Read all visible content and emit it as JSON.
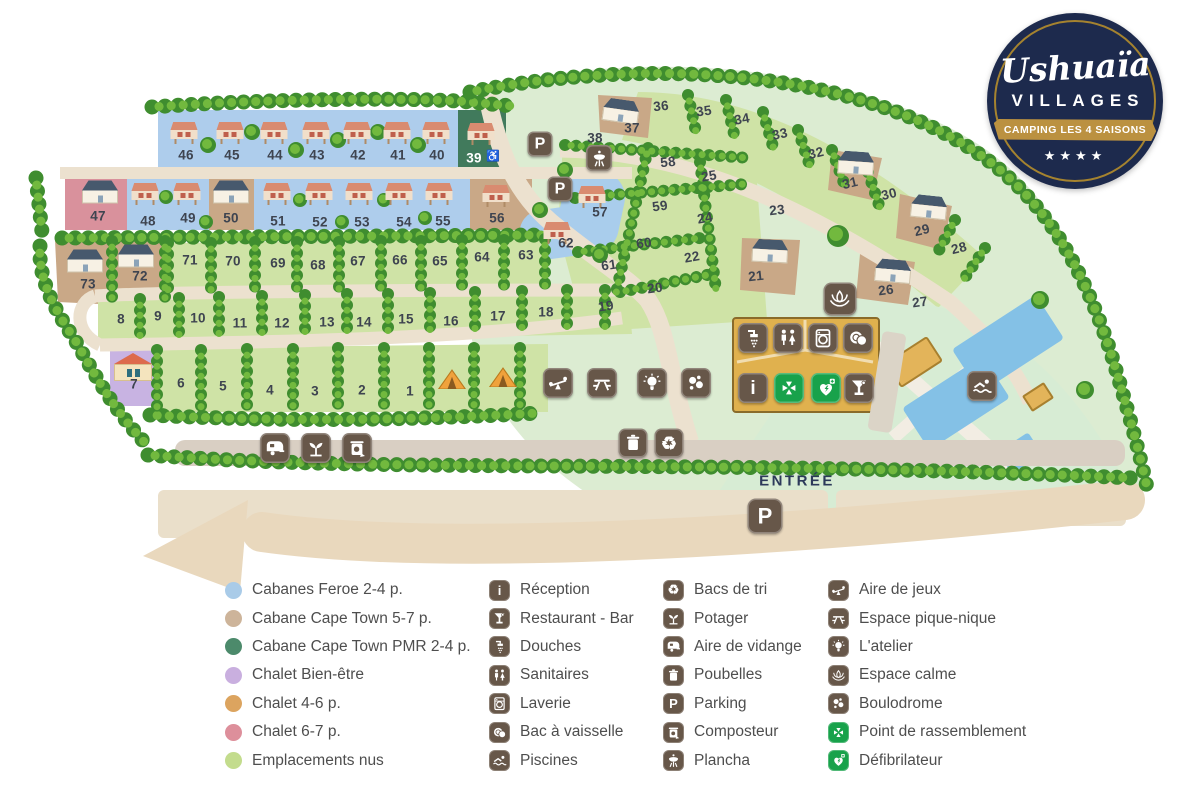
{
  "logo": {
    "brand": "Ushuaïa",
    "sub": "VILLAGES",
    "ribbon": "CAMPING LES 4 SAISONS",
    "stars": "★★★★"
  },
  "map": {
    "entrance_label": "ENTRÉE",
    "palette": {
      "pitch_green": "#cfe3a6",
      "zone_green": "#dcecd2",
      "road": "#ece1cf",
      "entry_road": "#d9cfc3",
      "swoosh": "#e9d8bd",
      "blue_cabins": "#aecdec",
      "tan": "#c9a887",
      "pink": "#d9919c",
      "pmr_green": "#417a5c",
      "purple": "#c8b3e2",
      "facility_block": "#e0b14e",
      "icon_brown": "#675749",
      "icon_green": "#18a24b",
      "pool_blue": "#84c1e6",
      "navy": "#1d2a4d"
    },
    "pitches": [
      {
        "n": "46",
        "x": 186,
        "y": 155
      },
      {
        "n": "45",
        "x": 232,
        "y": 155
      },
      {
        "n": "44",
        "x": 275,
        "y": 155
      },
      {
        "n": "43",
        "x": 317,
        "y": 155
      },
      {
        "n": "42",
        "x": 358,
        "y": 155
      },
      {
        "n": "41",
        "x": 398,
        "y": 155
      },
      {
        "n": "40",
        "x": 437,
        "y": 155
      },
      {
        "n": "39",
        "x": 474,
        "y": 158,
        "light": true
      },
      {
        "n": "38",
        "x": 595,
        "y": 138
      },
      {
        "n": "37",
        "x": 632,
        "y": 128
      },
      {
        "n": "47",
        "x": 98,
        "y": 216
      },
      {
        "n": "48",
        "x": 148,
        "y": 221
      },
      {
        "n": "49",
        "x": 188,
        "y": 218
      },
      {
        "n": "50",
        "x": 231,
        "y": 218
      },
      {
        "n": "51",
        "x": 278,
        "y": 221
      },
      {
        "n": "52",
        "x": 320,
        "y": 222
      },
      {
        "n": "53",
        "x": 362,
        "y": 222
      },
      {
        "n": "54",
        "x": 404,
        "y": 222
      },
      {
        "n": "55",
        "x": 443,
        "y": 221
      },
      {
        "n": "56",
        "x": 497,
        "y": 218
      },
      {
        "n": "57",
        "x": 600,
        "y": 212
      },
      {
        "n": "62",
        "x": 566,
        "y": 243
      },
      {
        "n": "36",
        "x": 661,
        "y": 106,
        "r": -6
      },
      {
        "n": "35",
        "x": 704,
        "y": 111,
        "r": -8
      },
      {
        "n": "34",
        "x": 742,
        "y": 119,
        "r": -10
      },
      {
        "n": "33",
        "x": 780,
        "y": 134,
        "r": -12
      },
      {
        "n": "32",
        "x": 816,
        "y": 153,
        "r": -14
      },
      {
        "n": "31",
        "x": 850,
        "y": 183,
        "r": -14
      },
      {
        "n": "30",
        "x": 889,
        "y": 194,
        "r": -14
      },
      {
        "n": "29",
        "x": 922,
        "y": 230,
        "r": -14
      },
      {
        "n": "28",
        "x": 959,
        "y": 248,
        "r": -14
      },
      {
        "n": "27",
        "x": 920,
        "y": 302,
        "r": -8
      },
      {
        "n": "26",
        "x": 886,
        "y": 290,
        "r": -8
      },
      {
        "n": "25",
        "x": 709,
        "y": 176,
        "r": -10
      },
      {
        "n": "24",
        "x": 705,
        "y": 218,
        "r": -10
      },
      {
        "n": "23",
        "x": 777,
        "y": 210,
        "r": -6
      },
      {
        "n": "22",
        "x": 692,
        "y": 257,
        "r": -10
      },
      {
        "n": "21",
        "x": 756,
        "y": 276,
        "r": -6
      },
      {
        "n": "20",
        "x": 655,
        "y": 288,
        "r": -8
      },
      {
        "n": "19",
        "x": 606,
        "y": 306,
        "r": -8
      },
      {
        "n": "58",
        "x": 668,
        "y": 162,
        "r": -6
      },
      {
        "n": "59",
        "x": 660,
        "y": 206,
        "r": -8
      },
      {
        "n": "60",
        "x": 644,
        "y": 243,
        "r": -8
      },
      {
        "n": "61",
        "x": 609,
        "y": 265,
        "r": -8
      },
      {
        "n": "73",
        "x": 88,
        "y": 284
      },
      {
        "n": "72",
        "x": 140,
        "y": 276
      },
      {
        "n": "71",
        "x": 190,
        "y": 260
      },
      {
        "n": "70",
        "x": 233,
        "y": 261
      },
      {
        "n": "69",
        "x": 278,
        "y": 263
      },
      {
        "n": "68",
        "x": 318,
        "y": 265
      },
      {
        "n": "67",
        "x": 358,
        "y": 261
      },
      {
        "n": "66",
        "x": 400,
        "y": 260
      },
      {
        "n": "65",
        "x": 440,
        "y": 261
      },
      {
        "n": "64",
        "x": 482,
        "y": 257
      },
      {
        "n": "63",
        "x": 526,
        "y": 255
      },
      {
        "n": "8",
        "x": 121,
        "y": 319
      },
      {
        "n": "9",
        "x": 158,
        "y": 316
      },
      {
        "n": "10",
        "x": 198,
        "y": 318
      },
      {
        "n": "11",
        "x": 240,
        "y": 323
      },
      {
        "n": "12",
        "x": 282,
        "y": 323
      },
      {
        "n": "13",
        "x": 327,
        "y": 322
      },
      {
        "n": "14",
        "x": 364,
        "y": 322
      },
      {
        "n": "15",
        "x": 406,
        "y": 319
      },
      {
        "n": "16",
        "x": 451,
        "y": 321
      },
      {
        "n": "17",
        "x": 498,
        "y": 316
      },
      {
        "n": "18",
        "x": 546,
        "y": 312
      },
      {
        "n": "7",
        "x": 134,
        "y": 384
      },
      {
        "n": "6",
        "x": 181,
        "y": 383
      },
      {
        "n": "5",
        "x": 223,
        "y": 386
      },
      {
        "n": "4",
        "x": 270,
        "y": 390
      },
      {
        "n": "3",
        "x": 315,
        "y": 391
      },
      {
        "n": "2",
        "x": 362,
        "y": 390
      },
      {
        "n": "1",
        "x": 410,
        "y": 391
      }
    ],
    "buildings": [
      {
        "t": "cabin",
        "x": 184,
        "y": 133
      },
      {
        "t": "cabin",
        "x": 230,
        "y": 133
      },
      {
        "t": "cabin",
        "x": 274,
        "y": 133
      },
      {
        "t": "cabin",
        "x": 316,
        "y": 133
      },
      {
        "t": "cabin",
        "x": 357,
        "y": 133
      },
      {
        "t": "cabin",
        "x": 397,
        "y": 133
      },
      {
        "t": "cabin",
        "x": 436,
        "y": 133
      },
      {
        "t": "cabin",
        "x": 481,
        "y": 134
      },
      {
        "t": "cabin",
        "x": 145,
        "y": 194
      },
      {
        "t": "cabin",
        "x": 187,
        "y": 194
      },
      {
        "t": "cabin",
        "x": 277,
        "y": 194
      },
      {
        "t": "cabin",
        "x": 319,
        "y": 194
      },
      {
        "t": "cabin",
        "x": 359,
        "y": 194
      },
      {
        "t": "cabin",
        "x": 399,
        "y": 194
      },
      {
        "t": "cabin",
        "x": 439,
        "y": 194
      },
      {
        "t": "cabin",
        "x": 592,
        "y": 197
      },
      {
        "t": "cabin",
        "x": 557,
        "y": 233
      },
      {
        "t": "cabin",
        "x": 496,
        "y": 196
      },
      {
        "t": "house",
        "x": 100,
        "y": 192
      },
      {
        "t": "house",
        "x": 231,
        "y": 192
      },
      {
        "t": "house",
        "x": 85,
        "y": 261
      },
      {
        "t": "house",
        "x": 136,
        "y": 256
      },
      {
        "t": "house",
        "x": 621,
        "y": 111,
        "r": 8
      },
      {
        "t": "house",
        "x": 856,
        "y": 163,
        "r": 4
      },
      {
        "t": "house",
        "x": 929,
        "y": 207,
        "r": 6
      },
      {
        "t": "house",
        "x": 770,
        "y": 251,
        "r": 3
      },
      {
        "t": "house",
        "x": 893,
        "y": 271,
        "r": 5
      },
      {
        "t": "chalet",
        "x": 133,
        "y": 367
      },
      {
        "t": "tent",
        "x": 452,
        "y": 379
      },
      {
        "t": "tent",
        "x": 503,
        "y": 377
      },
      {
        "t": "shed",
        "x": 914,
        "y": 362,
        "r": -33
      },
      {
        "t": "shed-sm",
        "x": 1038,
        "y": 397,
        "r": -33
      },
      {
        "t": "hall",
        "x": 887,
        "y": 382,
        "r": 9
      }
    ],
    "icons": [
      {
        "name": "parking-upper",
        "text": "P",
        "x": 540,
        "y": 144,
        "s": 25
      },
      {
        "name": "parking-mid",
        "text": "P",
        "x": 560,
        "y": 189,
        "s": 25
      },
      {
        "name": "plancha-map",
        "sym": "grill",
        "x": 599,
        "y": 158,
        "s": 26
      },
      {
        "name": "espace-calme-map",
        "sym": "lotus",
        "x": 840,
        "y": 299,
        "s": 33
      },
      {
        "name": "douches-map",
        "sym": "shower",
        "x": 753,
        "y": 338,
        "s": 30
      },
      {
        "name": "sanitaires-map",
        "sym": "wc",
        "x": 788,
        "y": 338,
        "s": 30
      },
      {
        "name": "laverie-map",
        "sym": "washer",
        "x": 823,
        "y": 338,
        "s": 30
      },
      {
        "name": "bac-vaisselle-map",
        "sym": "dishes",
        "x": 858,
        "y": 338,
        "s": 30
      },
      {
        "name": "reception-map",
        "text": "i",
        "x": 753,
        "y": 388,
        "s": 30
      },
      {
        "name": "rassemblement-map",
        "sym": "assembly",
        "x": 789,
        "y": 388,
        "s": 30,
        "green": true
      },
      {
        "name": "defibrilateur-map",
        "sym": "defib",
        "x": 826,
        "y": 388,
        "s": 30,
        "green": true
      },
      {
        "name": "restaurant-map",
        "sym": "bar",
        "x": 859,
        "y": 388,
        "s": 30
      },
      {
        "name": "aire-jeux-map",
        "sym": "seesaw",
        "x": 558,
        "y": 383,
        "s": 30
      },
      {
        "name": "pique-nique-map",
        "sym": "picnic",
        "x": 602,
        "y": 383,
        "s": 30
      },
      {
        "name": "atelier-map",
        "sym": "bulb",
        "x": 652,
        "y": 383,
        "s": 30
      },
      {
        "name": "boulodrome-map",
        "sym": "boules",
        "x": 696,
        "y": 383,
        "s": 30
      },
      {
        "name": "poubelles-map",
        "sym": "trash",
        "x": 633,
        "y": 443,
        "s": 29
      },
      {
        "name": "bacs-tri-map",
        "text": "♻",
        "x": 669,
        "y": 443,
        "s": 29
      },
      {
        "name": "aire-vidange-map",
        "sym": "caravan",
        "x": 275,
        "y": 448,
        "s": 30
      },
      {
        "name": "potager-map",
        "sym": "sprout",
        "x": 316,
        "y": 448,
        "s": 30
      },
      {
        "name": "composteur-map",
        "sym": "compost",
        "x": 357,
        "y": 448,
        "s": 30
      },
      {
        "name": "piscines-map",
        "sym": "swim",
        "x": 982,
        "y": 386,
        "s": 30
      },
      {
        "name": "parking-entrance",
        "text": "P",
        "x": 765,
        "y": 516,
        "s": 35
      },
      {
        "name": "wheelchair-map",
        "text": "♿",
        "x": 493,
        "y": 157,
        "s": 17,
        "plain": true
      }
    ]
  },
  "legend": {
    "accommodations": [
      {
        "color": "#a9cbe8",
        "label": "Cabanes Feroe 2-4 p."
      },
      {
        "color": "#cdb49a",
        "label": "Cabane Cape Town 5-7 p."
      },
      {
        "color": "#4c8a6b",
        "label": "Cabane Cape Town PMR 2-4 p."
      },
      {
        "color": "#c9afdf",
        "label": "Chalet Bien-être"
      },
      {
        "color": "#dca45f",
        "label": "Chalet 4-6 p."
      },
      {
        "color": "#dd8f9b",
        "label": "Chalet 6-7 p."
      },
      {
        "color": "#c3dc8d",
        "label": "Emplacements nus"
      }
    ],
    "facilities": [
      {
        "text": "i",
        "label": "Réception"
      },
      {
        "sym": "bar",
        "label": "Restaurant - Bar"
      },
      {
        "sym": "shower",
        "label": "Douches"
      },
      {
        "sym": "wc",
        "label": "Sanitaires"
      },
      {
        "sym": "washer",
        "label": "Laverie"
      },
      {
        "sym": "dishes",
        "label": "Bac à vaisselle"
      },
      {
        "sym": "swim",
        "label": "Piscines"
      }
    ],
    "services": [
      {
        "text": "♻",
        "label": "Bacs de tri"
      },
      {
        "sym": "sprout",
        "label": "Potager"
      },
      {
        "sym": "caravan",
        "label": "Aire de vidange"
      },
      {
        "sym": "trash",
        "label": "Poubelles"
      },
      {
        "text": "P",
        "label": "Parking"
      },
      {
        "sym": "compost",
        "label": "Composteur"
      },
      {
        "sym": "grill",
        "label": "Plancha"
      }
    ],
    "activities": [
      {
        "sym": "seesaw",
        "label": "Aire de jeux"
      },
      {
        "sym": "picnic",
        "label": "Espace pique-nique"
      },
      {
        "sym": "bulb",
        "label": "L'atelier"
      },
      {
        "sym": "lotus",
        "label": "Espace calme"
      },
      {
        "sym": "boules",
        "label": "Boulodrome"
      },
      {
        "sym": "assembly",
        "label": "Point de rassemblement",
        "green": true
      },
      {
        "sym": "defib",
        "label": "Défibrilateur",
        "green": true
      }
    ]
  }
}
